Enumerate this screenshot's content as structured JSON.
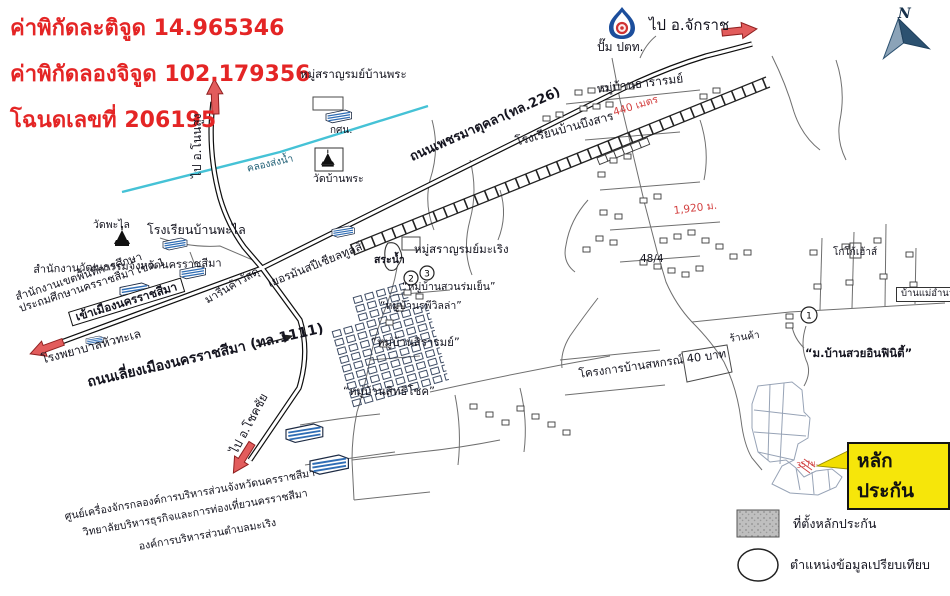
{
  "header": {
    "lines": [
      "ค่าพิกัดละติจูด 14.965346",
      "ค่าพิกัดลองจิจูด 102.179356",
      "โฉนดเลขที่ 206195"
    ]
  },
  "compass": {
    "north": "N"
  },
  "labels": {
    "to_nonsung": "ไป อ.โนนสูง",
    "to_chakkarat": "ไป อ.จักราช",
    "to_chokchai": "ไป อ.โชคชัย",
    "road_226": "ถนนเพชรมาตุคลา(ทล.226)",
    "road_1111": "ถนนเลี่ยงเมืองนครราชสีมา (ทล.1111)",
    "into_city": "เข้าเมืองนครราชสีมา",
    "canal": "คลองส่งน้ำ",
    "saran_banphra": "หมู่สราญรมย์บ้านพระ",
    "nfe": "กศน.",
    "wat_banphra": "วัดบ้านพระ",
    "ptt": "ปั๊ม ปตท.",
    "tararom": "หมู่บ้านธารารมย์",
    "school_buengsan": "โรงเรียนบ้านบึงสาร",
    "wat_phalai": "วัดพะไล",
    "school_phalai": "โรงเรียนบ้านพะไล",
    "culture_office": "สำนักงานวัฒนธรรมจังหวัดนครราชสีมา",
    "edu_area_line1": "สำนักงานเขตพื้นที่การศึกษา",
    "edu_area_line2": "ประถมศึกษานครราชสีมา เขต 1",
    "hospital": "โรงพยาบาลหัวทะเล",
    "marin_materials": "มารีนค้าวัสดุ",
    "german_tools": "เยอรมันสปีเชียลทูลส์",
    "saran_maroeng": "หมู่สราญรมย์มะเริง",
    "pond": "สระน้ำ",
    "suan_romyen": "“หมู่บ้านสวนร่มเย็น”",
    "rapee_villa": "“หมู่บ้านรพีวิลล่า”",
    "sirarom": "“หมู่บ้านสิรารมย์”",
    "sitthichok": "“หมู่บ้านสิทธิโชค”",
    "machinery_center": "ศูนย์เครื่องจักรกลองค์การบริหารส่วนจังหวัดนครราชสีมา",
    "college": "วิทยาลัยบริหารธุรกิจและการท่องเที่ยวนครราชสีมา",
    "sao_maroeng": "องค์การบริหารส่วนตำบลมะเริง",
    "sahakorn_project": "โครงการบ้านสหกรณ์ 40 บาท",
    "shop": "ร้านค้า",
    "koko_house": "โกโก้เฮ้าส์",
    "ban_mae_amnuay": "บ้านแม่อำนวย",
    "infinity_village": "“ม.บ้านสวยอินฟินิตี้”",
    "house_no": "48/4"
  },
  "distances": {
    "d440": "440 เมตร",
    "d1920": "1,920 ม.",
    "d357": "357ม."
  },
  "markers": {
    "m1": "1",
    "m2": "2",
    "m3": "3"
  },
  "callout": {
    "collateral": "หลักประกัน"
  },
  "legend": {
    "site": "ที่ตั้งหลักประกัน",
    "compare": "ตำแหน่งข้อมูลเปรียบเทียบ"
  },
  "colors": {
    "header_red": "#e42525",
    "distance_red": "#d34040",
    "highlight_yellow": "#f6e60a",
    "canal_blue": "#45c2d6",
    "building_blue": "#2f6db5"
  }
}
